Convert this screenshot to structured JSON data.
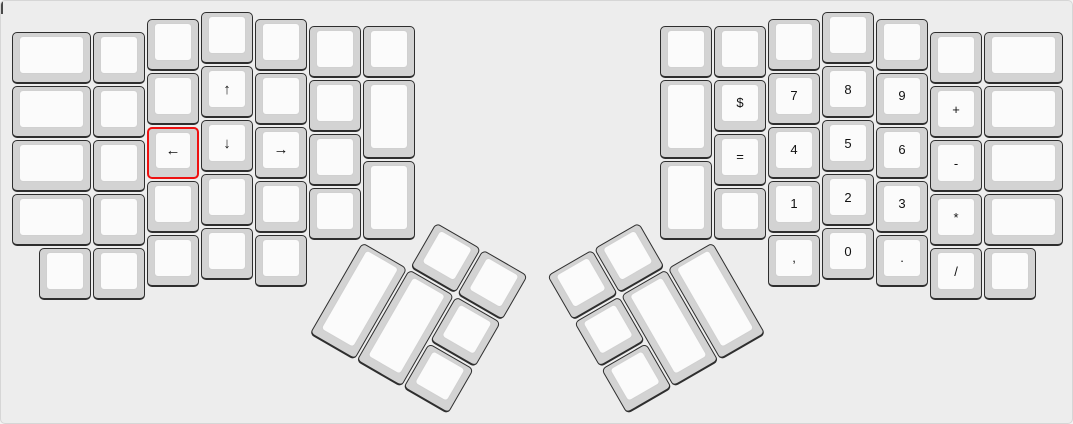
{
  "app": {
    "view": "ergodox-keyboard-layout-canvas"
  },
  "colors": {
    "background": "#ededed",
    "board_border": "#d6d6d6",
    "key_base": "#d3d3d3",
    "key_top": "#fbfbfb",
    "key_top_border": "#d0d0d0",
    "key_border": "#2e2e2e",
    "highlight_border": "#ee1111",
    "label": "#111111"
  },
  "selection": {
    "highlighted_key": "key-left-arrow",
    "highlight_style": "red-border"
  },
  "layout": {
    "unit_px": 54,
    "margin_px": 10,
    "groups": [
      {
        "name": "left-main-matrix",
        "rotation": 0,
        "origin": [
          0,
          0
        ],
        "keys": [
          {
            "x": 0,
            "y": 0.375,
            "w": 1.5,
            "h": 1,
            "label": ""
          },
          {
            "x": 0,
            "y": 1.375,
            "w": 1.5,
            "h": 1,
            "label": ""
          },
          {
            "x": 0,
            "y": 2.375,
            "w": 1.5,
            "h": 1,
            "label": ""
          },
          {
            "x": 0,
            "y": 3.375,
            "w": 1.5,
            "h": 1,
            "label": ""
          },
          {
            "x": 0.5,
            "y": 4.375,
            "w": 1,
            "h": 1,
            "label": ""
          },
          {
            "x": 1.5,
            "y": 0.375,
            "w": 1,
            "h": 1,
            "label": ""
          },
          {
            "x": 1.5,
            "y": 1.375,
            "w": 1,
            "h": 1,
            "label": ""
          },
          {
            "x": 1.5,
            "y": 2.375,
            "w": 1,
            "h": 1,
            "label": ""
          },
          {
            "x": 1.5,
            "y": 3.375,
            "w": 1,
            "h": 1,
            "label": ""
          },
          {
            "x": 1.5,
            "y": 4.375,
            "w": 1,
            "h": 1,
            "label": ""
          },
          {
            "x": 2.5,
            "y": 0.125,
            "w": 1,
            "h": 1,
            "label": ""
          },
          {
            "x": 2.5,
            "y": 1.125,
            "w": 1,
            "h": 1,
            "label": ""
          },
          {
            "x": 2.5,
            "y": 2.125,
            "w": 1,
            "h": 1,
            "label": "←",
            "fs": 15,
            "name": "key-left-arrow",
            "highlight": true
          },
          {
            "x": 2.5,
            "y": 3.125,
            "w": 1,
            "h": 1,
            "label": ""
          },
          {
            "x": 2.5,
            "y": 4.125,
            "w": 1,
            "h": 1,
            "label": ""
          },
          {
            "x": 3.5,
            "y": 0,
            "w": 1,
            "h": 1,
            "label": ""
          },
          {
            "x": 3.5,
            "y": 1,
            "w": 1,
            "h": 1,
            "label": "↑",
            "fs": 15,
            "name": "key-up-arrow"
          },
          {
            "x": 3.5,
            "y": 2,
            "w": 1,
            "h": 1,
            "label": "↓",
            "fs": 15,
            "name": "key-down-arrow"
          },
          {
            "x": 3.5,
            "y": 3,
            "w": 1,
            "h": 1,
            "label": ""
          },
          {
            "x": 3.5,
            "y": 4,
            "w": 1,
            "h": 1,
            "label": ""
          },
          {
            "x": 4.5,
            "y": 0.125,
            "w": 1,
            "h": 1,
            "label": ""
          },
          {
            "x": 4.5,
            "y": 1.125,
            "w": 1,
            "h": 1,
            "label": ""
          },
          {
            "x": 4.5,
            "y": 2.125,
            "w": 1,
            "h": 1,
            "label": "→",
            "fs": 15,
            "name": "key-right-arrow"
          },
          {
            "x": 4.5,
            "y": 3.125,
            "w": 1,
            "h": 1,
            "label": ""
          },
          {
            "x": 4.5,
            "y": 4.125,
            "w": 1,
            "h": 1,
            "label": ""
          },
          {
            "x": 5.5,
            "y": 0.25,
            "w": 1,
            "h": 1,
            "label": ""
          },
          {
            "x": 5.5,
            "y": 1.25,
            "w": 1,
            "h": 1,
            "label": ""
          },
          {
            "x": 5.5,
            "y": 2.25,
            "w": 1,
            "h": 1,
            "label": ""
          },
          {
            "x": 5.5,
            "y": 3.25,
            "w": 1,
            "h": 1,
            "label": ""
          },
          {
            "x": 6.5,
            "y": 0.25,
            "w": 1,
            "h": 1,
            "label": ""
          },
          {
            "x": 6.5,
            "y": 1.25,
            "w": 1,
            "h": 1.5,
            "label": ""
          },
          {
            "x": 6.5,
            "y": 2.75,
            "w": 1,
            "h": 1.5,
            "label": ""
          }
        ]
      },
      {
        "name": "left-thumb-cluster",
        "rotation": 30,
        "origin": [
          6.5,
          4.25
        ],
        "keys": [
          {
            "x": 1,
            "y": -1,
            "w": 1,
            "h": 1,
            "label": ""
          },
          {
            "x": 2,
            "y": -1,
            "w": 1,
            "h": 1,
            "label": ""
          },
          {
            "x": 0,
            "y": 0,
            "w": 1,
            "h": 2,
            "label": ""
          },
          {
            "x": 1,
            "y": 0,
            "w": 1,
            "h": 2,
            "label": ""
          },
          {
            "x": 2,
            "y": 0,
            "w": 1,
            "h": 1,
            "label": ""
          },
          {
            "x": 2,
            "y": 1,
            "w": 1,
            "h": 1,
            "label": ""
          }
        ]
      },
      {
        "name": "right-main-matrix",
        "rotation": 0,
        "origin": [
          0,
          0
        ],
        "keys": [
          {
            "x": 12,
            "y": 0.25,
            "w": 1,
            "h": 1,
            "label": ""
          },
          {
            "x": 12,
            "y": 1.25,
            "w": 1,
            "h": 1.5,
            "label": ""
          },
          {
            "x": 12,
            "y": 2.75,
            "w": 1,
            "h": 1.5,
            "label": ""
          },
          {
            "x": 13,
            "y": 0.25,
            "w": 1,
            "h": 1,
            "label": ""
          },
          {
            "x": 13,
            "y": 1.25,
            "w": 1,
            "h": 1,
            "label": "$",
            "name": "key-dollar"
          },
          {
            "x": 13,
            "y": 2.25,
            "w": 1,
            "h": 1,
            "label": "=",
            "name": "key-equals"
          },
          {
            "x": 13,
            "y": 3.25,
            "w": 1,
            "h": 1,
            "label": ""
          },
          {
            "x": 14,
            "y": 0.125,
            "w": 1,
            "h": 1,
            "label": ""
          },
          {
            "x": 14,
            "y": 1.125,
            "w": 1,
            "h": 1,
            "label": "7",
            "name": "key-7"
          },
          {
            "x": 14,
            "y": 2.125,
            "w": 1,
            "h": 1,
            "label": "4",
            "name": "key-4"
          },
          {
            "x": 14,
            "y": 3.125,
            "w": 1,
            "h": 1,
            "label": "1",
            "name": "key-1"
          },
          {
            "x": 14,
            "y": 4.125,
            "w": 1,
            "h": 1,
            "label": ",",
            "name": "key-comma"
          },
          {
            "x": 15,
            "y": 0,
            "w": 1,
            "h": 1,
            "label": ""
          },
          {
            "x": 15,
            "y": 1,
            "w": 1,
            "h": 1,
            "label": "8",
            "name": "key-8"
          },
          {
            "x": 15,
            "y": 2,
            "w": 1,
            "h": 1,
            "label": "5",
            "name": "key-5"
          },
          {
            "x": 15,
            "y": 3,
            "w": 1,
            "h": 1,
            "label": "2",
            "name": "key-2"
          },
          {
            "x": 15,
            "y": 4,
            "w": 1,
            "h": 1,
            "label": "0",
            "name": "key-0"
          },
          {
            "x": 16,
            "y": 0.125,
            "w": 1,
            "h": 1,
            "label": ""
          },
          {
            "x": 16,
            "y": 1.125,
            "w": 1,
            "h": 1,
            "label": "9",
            "name": "key-9"
          },
          {
            "x": 16,
            "y": 2.125,
            "w": 1,
            "h": 1,
            "label": "6",
            "name": "key-6"
          },
          {
            "x": 16,
            "y": 3.125,
            "w": 1,
            "h": 1,
            "label": "3",
            "name": "key-3"
          },
          {
            "x": 16,
            "y": 4.125,
            "w": 1,
            "h": 1,
            "label": ".",
            "name": "key-period"
          },
          {
            "x": 17,
            "y": 0.375,
            "w": 1,
            "h": 1,
            "label": ""
          },
          {
            "x": 17,
            "y": 1.375,
            "w": 1,
            "h": 1,
            "label": "+",
            "name": "key-plus"
          },
          {
            "x": 17,
            "y": 2.375,
            "w": 1,
            "h": 1,
            "label": "-",
            "name": "key-minus"
          },
          {
            "x": 17,
            "y": 3.375,
            "w": 1,
            "h": 1,
            "label": "*",
            "name": "key-asterisk"
          },
          {
            "x": 17,
            "y": 4.375,
            "w": 1,
            "h": 1,
            "label": "/",
            "name": "key-slash"
          },
          {
            "x": 18,
            "y": 0.375,
            "w": 1.5,
            "h": 1,
            "label": ""
          },
          {
            "x": 18,
            "y": 1.375,
            "w": 1.5,
            "h": 1,
            "label": ""
          },
          {
            "x": 18,
            "y": 2.375,
            "w": 1.5,
            "h": 1,
            "label": ""
          },
          {
            "x": 18,
            "y": 3.375,
            "w": 1.5,
            "h": 1,
            "label": ""
          },
          {
            "x": 18,
            "y": 4.375,
            "w": 1,
            "h": 1,
            "label": ""
          }
        ]
      },
      {
        "name": "right-thumb-cluster",
        "rotation": -30,
        "origin": [
          13,
          4.25
        ],
        "keys": [
          {
            "x": -3,
            "y": -1,
            "w": 1,
            "h": 1,
            "label": ""
          },
          {
            "x": -2,
            "y": -1,
            "w": 1,
            "h": 1,
            "label": ""
          },
          {
            "x": -3,
            "y": 0,
            "w": 1,
            "h": 1,
            "label": ""
          },
          {
            "x": -2,
            "y": 0,
            "w": 1,
            "h": 2,
            "label": ""
          },
          {
            "x": -1,
            "y": 0,
            "w": 1,
            "h": 2,
            "label": ""
          },
          {
            "x": -3,
            "y": 1,
            "w": 1,
            "h": 1,
            "label": ""
          }
        ]
      }
    ]
  }
}
